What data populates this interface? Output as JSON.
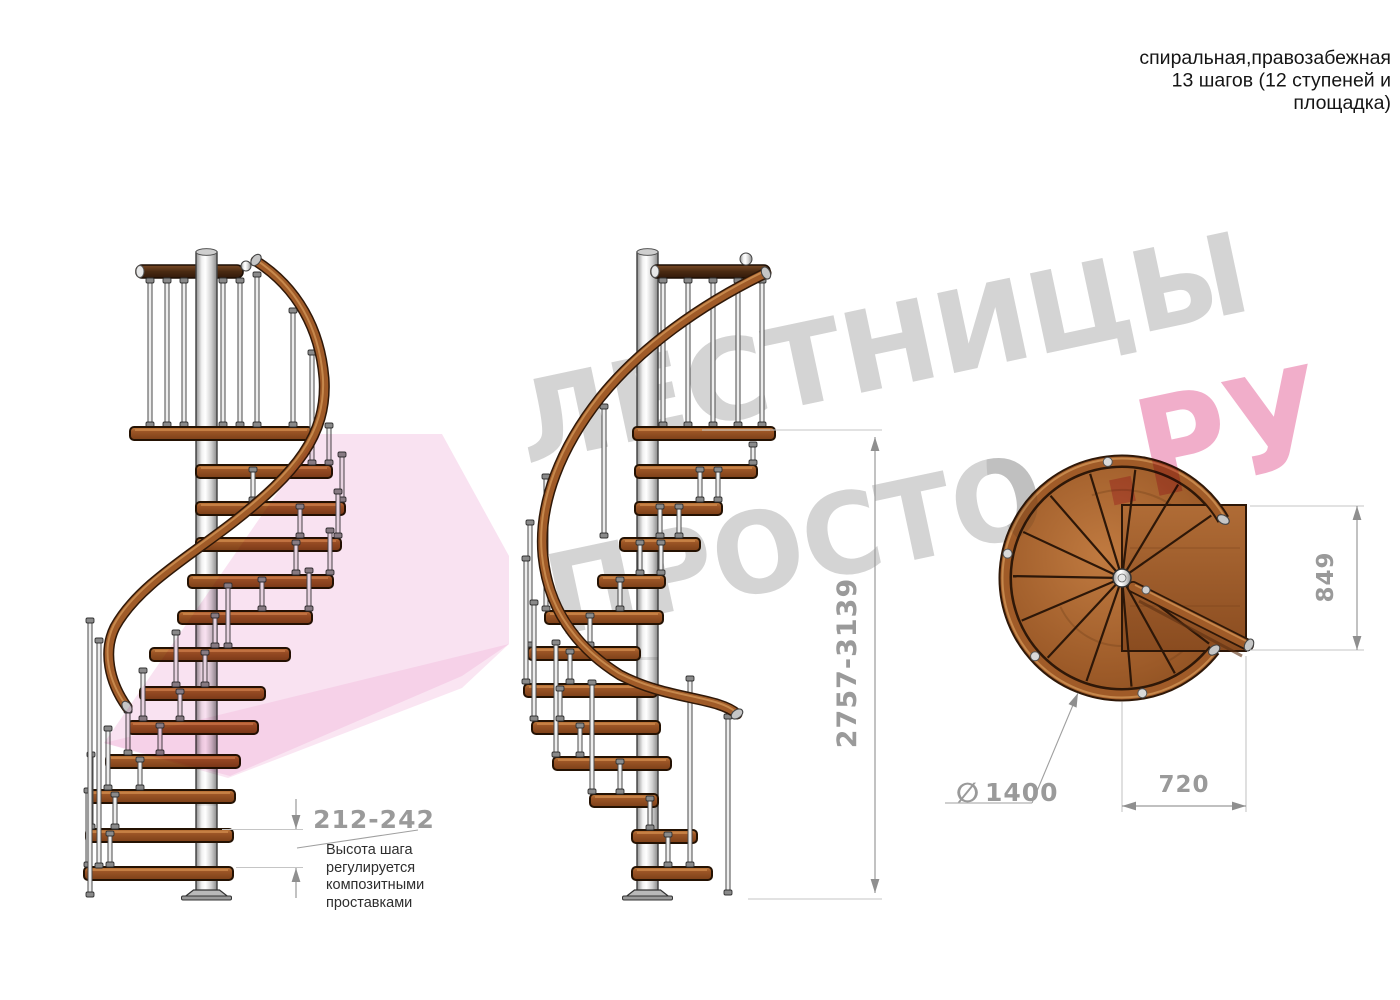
{
  "title_block": {
    "line1": "спиральная,правозабежная",
    "line2": "13 шагов (12 ступеней и",
    "line3": "площадка)"
  },
  "watermark": {
    "word1": "ЛЕСТНИЦЫ",
    "word2": "ПРОСТО",
    "suffix": ".РУ"
  },
  "dimensions": {
    "step_height": "212-242",
    "total_height": "2757-3139",
    "platform_side": "849",
    "diameter_symbol": "∅",
    "diameter": "1400",
    "platform_width": "720"
  },
  "annotations": {
    "step_height_note": [
      "Высота шага",
      "регулируется",
      "композитными",
      "проставками"
    ]
  },
  "colors": {
    "dimension_gray": "#9a9a9a",
    "extension_gray": "#c5c5c5",
    "watermark_gray": "#d4d4d4",
    "watermark_pink": "#f0a7c6",
    "ribbon_pink": "#f2bfe0",
    "wood": "#a05b28",
    "wood_dark": "#2f1808",
    "metal": "#d9d9d9"
  }
}
